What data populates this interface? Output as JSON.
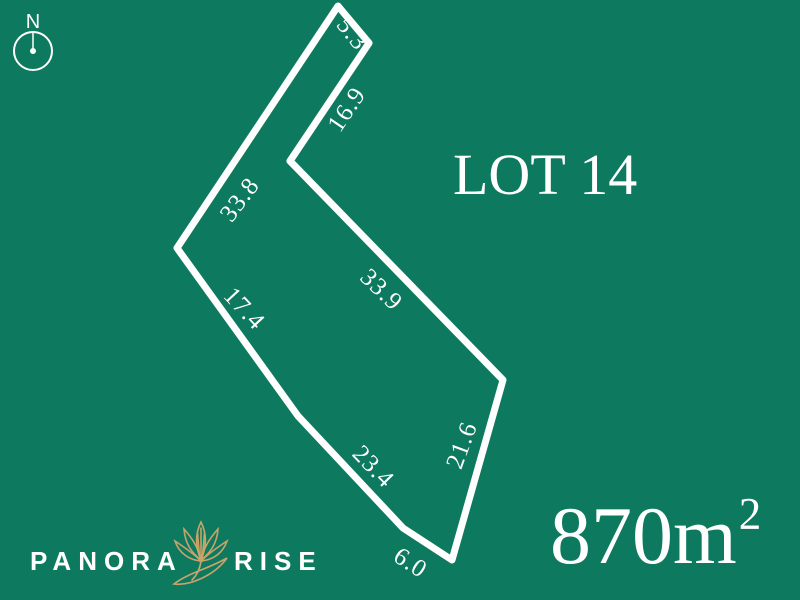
{
  "colors": {
    "background": "#0d7a5f",
    "foreground": "#ffffff",
    "gold": "#c9a46a"
  },
  "compass": {
    "label": "N"
  },
  "lot": {
    "title": "LOT 14",
    "area_value": "870m",
    "area_exponent": "2",
    "measurements": [
      {
        "edge": "top-spur-end",
        "value": "5.3"
      },
      {
        "edge": "spur-right-side",
        "value": "16.9"
      },
      {
        "edge": "north-west-boundary",
        "value": "33.8"
      },
      {
        "edge": "north-east-boundary",
        "value": "33.9"
      },
      {
        "edge": "west-boundary",
        "value": "17.4"
      },
      {
        "edge": "south-west-boundary",
        "value": "23.4"
      },
      {
        "edge": "south-east-boundary",
        "value": "21.6"
      },
      {
        "edge": "south-boundary",
        "value": "6.0"
      }
    ]
  },
  "brand": {
    "name_left": "PANORA",
    "name_right": "RISE"
  }
}
